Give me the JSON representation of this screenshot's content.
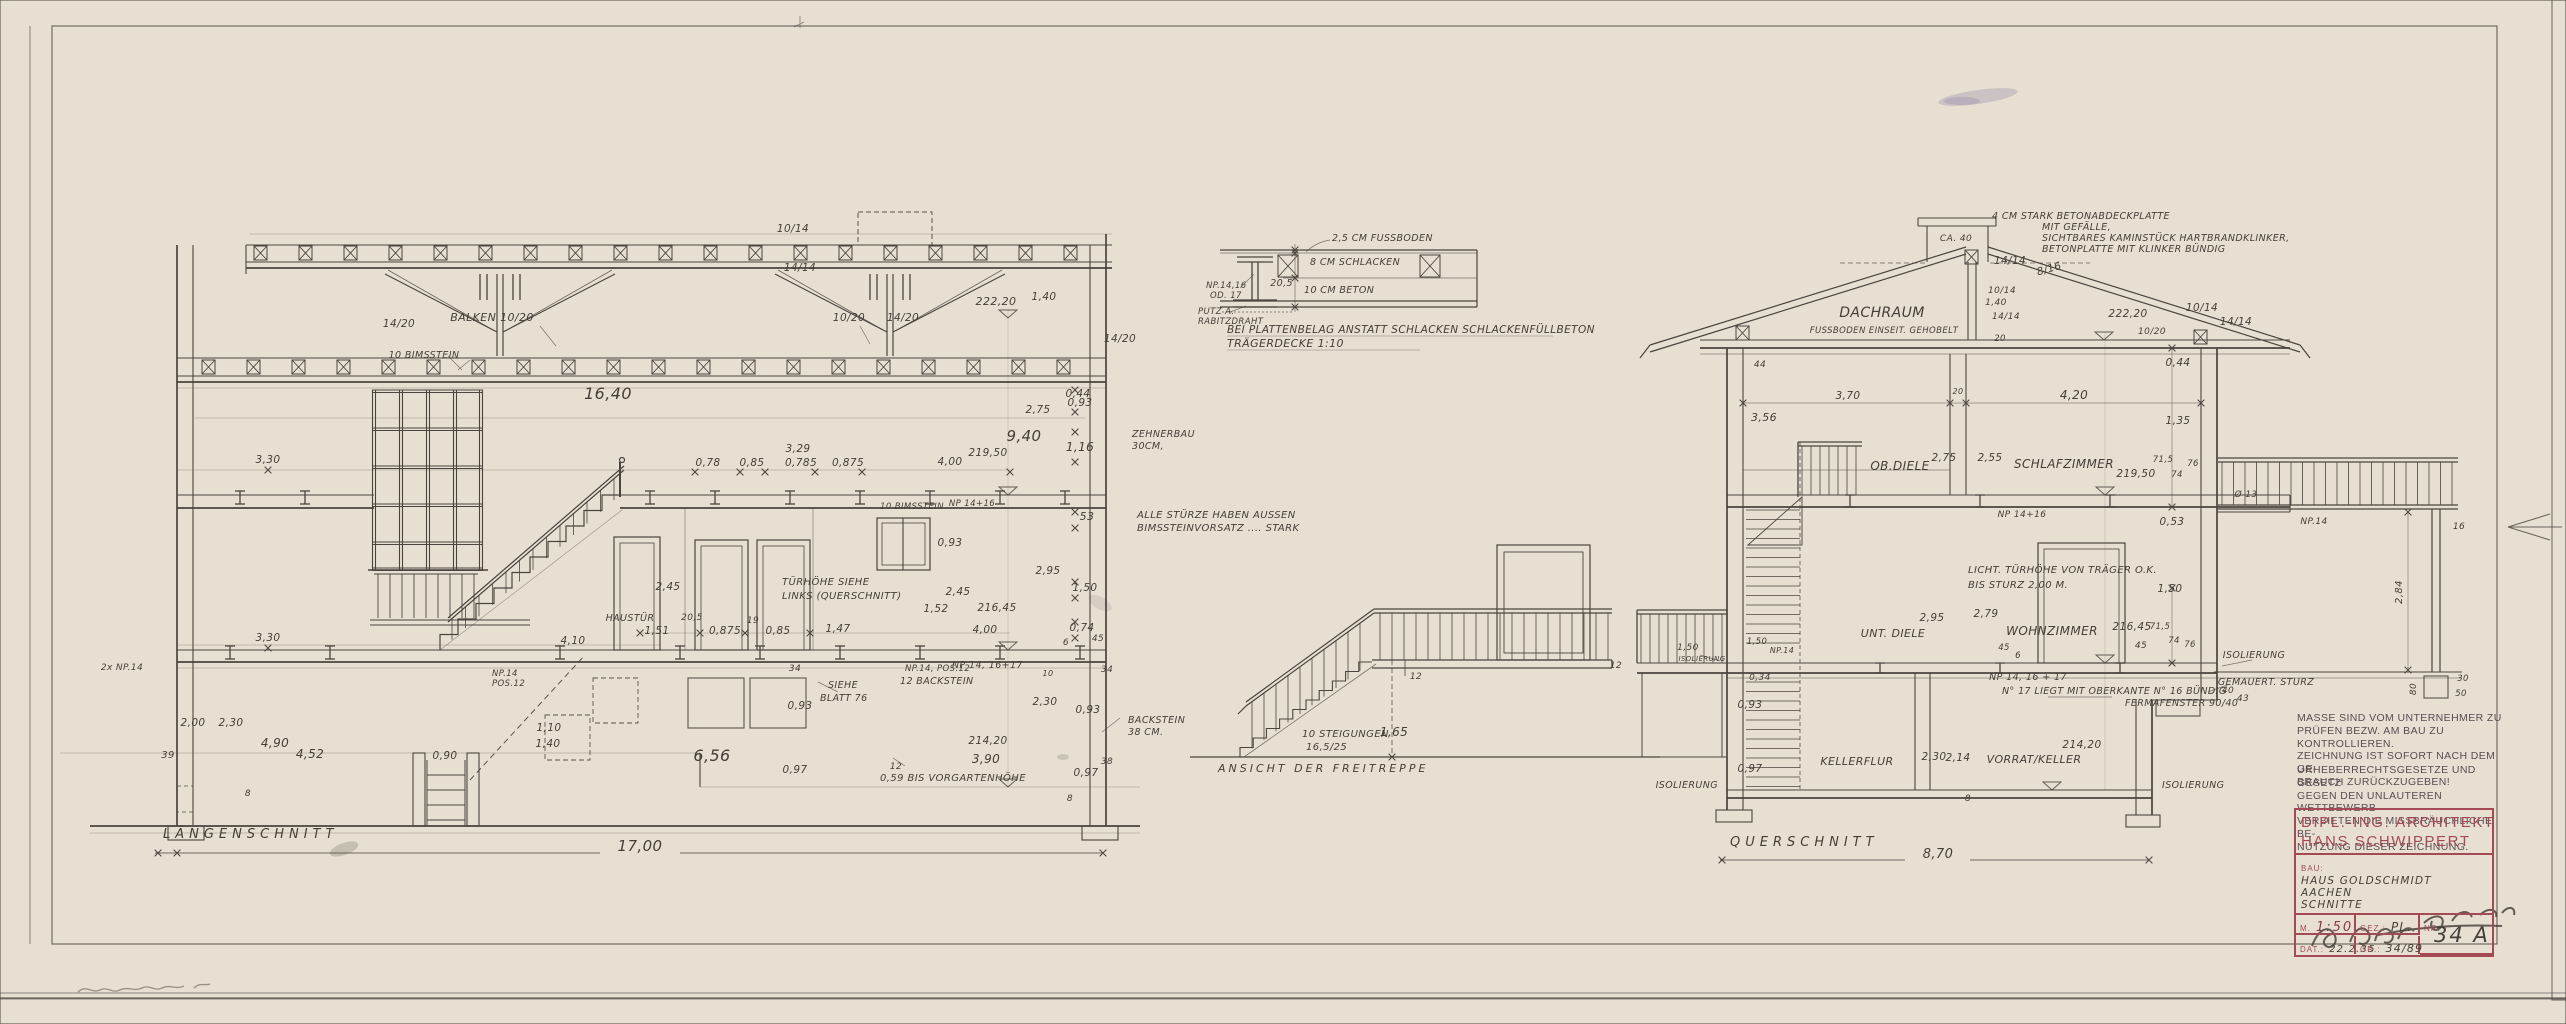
{
  "sheet": {
    "paper_color": "#e7dfd2",
    "ink_color": "#4a443e",
    "stamp_color": "#a34a56"
  },
  "drawings": {
    "laengsschnitt": {
      "title": "LÄNGENSCHNITT",
      "overall_dim": "17,00",
      "labels": [
        {
          "t": "10/14",
          "x": 793,
          "y": 232
        },
        {
          "t": "14/14",
          "x": 800,
          "y": 271
        },
        {
          "t": "14/20",
          "x": 399,
          "y": 327
        },
        {
          "t": "BALKEN 10/20",
          "x": 492,
          "y": 321,
          "s": 11
        },
        {
          "t": "10/20",
          "x": 849,
          "y": 321
        },
        {
          "t": "14/20",
          "x": 903,
          "y": 321
        },
        {
          "t": "14/20",
          "x": 1120,
          "y": 342
        },
        {
          "t": "10 BIMSSTEIN",
          "x": 424,
          "y": 358,
          "s": 9.5
        },
        {
          "t": "16,40",
          "x": 608,
          "y": 399,
          "s": 16
        },
        {
          "t": "222,20",
          "x": 996,
          "y": 305,
          "s": 11
        },
        {
          "t": "1,40",
          "x": 1044,
          "y": 300
        },
        {
          "t": "0,44",
          "x": 1078,
          "y": 397
        },
        {
          "t": "2,75",
          "x": 1038,
          "y": 413
        },
        {
          "t": "0,93",
          "x": 1080,
          "y": 406
        },
        {
          "t": "9,40",
          "x": 1024,
          "y": 441,
          "s": 15
        },
        {
          "t": "1,16",
          "x": 1080,
          "y": 451,
          "s": 12
        },
        {
          "t": "219,50",
          "x": 988,
          "y": 456
        },
        {
          "t": "4,00",
          "x": 950,
          "y": 465
        },
        {
          "t": "3,29",
          "x": 798,
          "y": 452
        },
        {
          "t": "0,78",
          "x": 708,
          "y": 466
        },
        {
          "t": "0,85",
          "x": 752,
          "y": 466
        },
        {
          "t": "0,785",
          "x": 801,
          "y": 466
        },
        {
          "t": "0,875",
          "x": 848,
          "y": 466
        },
        {
          "t": "ZEHNERBAU",
          "x": 1132,
          "y": 437,
          "a": "s",
          "s": 9.5
        },
        {
          "t": "30CM,",
          "x": 1132,
          "y": 449,
          "a": "s",
          "s": 9.5
        },
        {
          "t": "53",
          "x": 1087,
          "y": 520,
          "s": 11
        },
        {
          "t": "10 BIMSSTEIN",
          "x": 912,
          "y": 509,
          "s": 8.5
        },
        {
          "t": "NP 14+16",
          "x": 972,
          "y": 506,
          "s": 8.5
        },
        {
          "t": "ALLE STÜRZE HABEN AUSSEN",
          "x": 1137,
          "y": 518,
          "a": "s",
          "s": 10
        },
        {
          "t": "BIMSSTEINVORSATZ .... STARK",
          "x": 1137,
          "y": 531,
          "a": "s",
          "s": 10
        },
        {
          "t": "0,93",
          "x": 950,
          "y": 546
        },
        {
          "t": "2,95",
          "x": 1048,
          "y": 574
        },
        {
          "t": "1,50",
          "x": 1085,
          "y": 591
        },
        {
          "t": "2,45",
          "x": 668,
          "y": 590
        },
        {
          "t": "2,45",
          "x": 958,
          "y": 595
        },
        {
          "t": "1,52",
          "x": 936,
          "y": 612
        },
        {
          "t": "216,45",
          "x": 997,
          "y": 611
        },
        {
          "t": "TÜRHÖHE SIEHE",
          "x": 782,
          "y": 585,
          "a": "s",
          "s": 10
        },
        {
          "t": "LINKS (QUERSCHNITT)",
          "x": 782,
          "y": 599,
          "a": "s",
          "s": 10
        },
        {
          "t": "0,74",
          "x": 1082,
          "y": 631
        },
        {
          "t": "HAUSTÜR",
          "x": 630,
          "y": 621,
          "s": 9.5
        },
        {
          "t": "3,30",
          "x": 268,
          "y": 463
        },
        {
          "t": "3,30",
          "x": 268,
          "y": 641
        },
        {
          "t": "1,51",
          "x": 657,
          "y": 634
        },
        {
          "t": "4,10",
          "x": 573,
          "y": 644
        },
        {
          "t": "20,5",
          "x": 692,
          "y": 620,
          "s": 9
        },
        {
          "t": "19",
          "x": 753,
          "y": 623,
          "s": 9
        },
        {
          "t": "0,875",
          "x": 725,
          "y": 634
        },
        {
          "t": "0,85",
          "x": 778,
          "y": 634
        },
        {
          "t": "1,47",
          "x": 838,
          "y": 632
        },
        {
          "t": "4,00",
          "x": 985,
          "y": 633
        },
        {
          "t": "2x NP.14",
          "x": 122,
          "y": 670,
          "s": 9
        },
        {
          "t": "NP.14, POS.12",
          "x": 905,
          "y": 671,
          "a": "s",
          "s": 8.5
        },
        {
          "t": "12 BACKSTEIN",
          "x": 900,
          "y": 684,
          "a": "s",
          "s": 9.5
        },
        {
          "t": "NP 14, 16+17",
          "x": 952,
          "y": 668,
          "a": "s",
          "s": 9.5
        },
        {
          "t": "34",
          "x": 795,
          "y": 671,
          "s": 9
        },
        {
          "t": "SIEHE",
          "x": 828,
          "y": 688,
          "a": "s",
          "s": 9.5
        },
        {
          "t": "BLATT 76",
          "x": 820,
          "y": 701,
          "a": "s",
          "s": 9.5
        },
        {
          "t": "0,93",
          "x": 800,
          "y": 709
        },
        {
          "t": "2,30",
          "x": 1045,
          "y": 705
        },
        {
          "t": "0,93",
          "x": 1088,
          "y": 713
        },
        {
          "t": "2,00",
          "x": 193,
          "y": 726
        },
        {
          "t": "2,30",
          "x": 231,
          "y": 726
        },
        {
          "t": "4,90",
          "x": 275,
          "y": 747,
          "s": 12
        },
        {
          "t": "4,52",
          "x": 310,
          "y": 758,
          "s": 12
        },
        {
          "t": "39",
          "x": 168,
          "y": 758,
          "s": 10
        },
        {
          "t": "0,90",
          "x": 445,
          "y": 759
        },
        {
          "t": "1,40",
          "x": 548,
          "y": 747
        },
        {
          "t": "1,10",
          "x": 549,
          "y": 731
        },
        {
          "t": "NP.14",
          "x": 492,
          "y": 676,
          "a": "s",
          "s": 8.5
        },
        {
          "t": "POS.12",
          "x": 492,
          "y": 686,
          "a": "s",
          "s": 8.5
        },
        {
          "t": "6,56",
          "x": 712,
          "y": 761,
          "s": 16
        },
        {
          "t": "0,97",
          "x": 795,
          "y": 773
        },
        {
          "t": "0,59 BIS VORGARTENHÖHE",
          "x": 880,
          "y": 781,
          "a": "s",
          "s": 10
        },
        {
          "t": "12",
          "x": 896,
          "y": 769,
          "s": 9
        },
        {
          "t": "214,20",
          "x": 988,
          "y": 744
        },
        {
          "t": "3,90",
          "x": 986,
          "y": 763,
          "s": 12
        },
        {
          "t": "38",
          "x": 1107,
          "y": 764,
          "s": 9
        },
        {
          "t": "0,97",
          "x": 1086,
          "y": 776
        },
        {
          "t": "8",
          "x": 1070,
          "y": 801,
          "s": 9
        },
        {
          "t": "8",
          "x": 248,
          "y": 796,
          "s": 9
        },
        {
          "t": "6",
          "x": 1066,
          "y": 645,
          "s": 9
        },
        {
          "t": "45",
          "x": 1098,
          "y": 641,
          "s": 9
        },
        {
          "t": "34",
          "x": 1107,
          "y": 672,
          "s": 9
        },
        {
          "t": "10",
          "x": 1048,
          "y": 676,
          "s": 8
        },
        {
          "t": "BACKSTEIN",
          "x": 1128,
          "y": 723,
          "a": "s",
          "s": 9.5
        },
        {
          "t": "38 CM.",
          "x": 1128,
          "y": 735,
          "a": "s",
          "s": 9.5
        }
      ]
    },
    "querschnitt": {
      "title": "QUERSCHNITT",
      "overall_dim": "8,70",
      "labels": [
        {
          "t": "4 CM STARK BETONABDECKPLATTE",
          "x": 1992,
          "y": 219,
          "a": "s",
          "s": 9.5
        },
        {
          "t": "MIT GEFÄLLE,",
          "x": 2042,
          "y": 230,
          "a": "s",
          "s": 9.5
        },
        {
          "t": "SICHTBARES KAMINSTÜCK HARTBRANDKLINKER,",
          "x": 2042,
          "y": 241,
          "a": "s",
          "s": 9.5
        },
        {
          "t": "BETONPLATTE MIT KLINKER BÜNDIG",
          "x": 2042,
          "y": 252,
          "a": "s",
          "s": 9.5
        },
        {
          "t": "CA. 40",
          "x": 1956,
          "y": 241,
          "s": 9
        },
        {
          "t": "14/14",
          "x": 2010,
          "y": 264
        },
        {
          "t": "8/16",
          "x": 2050,
          "y": 272,
          "r": -16
        },
        {
          "t": "10/14",
          "x": 2002,
          "y": 293,
          "s": 9
        },
        {
          "t": "1,40",
          "x": 1996,
          "y": 305,
          "s": 9
        },
        {
          "t": "14/14",
          "x": 2006,
          "y": 319,
          "s": 9
        },
        {
          "t": "10/14",
          "x": 2202,
          "y": 311
        },
        {
          "t": "14/14",
          "x": 2236,
          "y": 325
        },
        {
          "t": "10/20",
          "x": 2152,
          "y": 334,
          "s": 9
        },
        {
          "t": "222,20",
          "x": 2128,
          "y": 317
        },
        {
          "t": "20",
          "x": 2000,
          "y": 341,
          "s": 8.5
        },
        {
          "t": "44",
          "x": 1760,
          "y": 367,
          "s": 9
        },
        {
          "t": "DACHRAUM",
          "x": 1882,
          "y": 317,
          "s": 14
        },
        {
          "t": "FUSSBODEN EINSEIT. GEHOBELT",
          "x": 1884,
          "y": 333,
          "s": 8.5
        },
        {
          "t": "3,70",
          "x": 1848,
          "y": 399
        },
        {
          "t": "20",
          "x": 1958,
          "y": 394,
          "s": 8
        },
        {
          "t": "4,20",
          "x": 2074,
          "y": 399,
          "s": 12
        },
        {
          "t": "3,56",
          "x": 1764,
          "y": 421,
          "s": 11
        },
        {
          "t": "0,44",
          "x": 2178,
          "y": 366
        },
        {
          "t": "1,35",
          "x": 2178,
          "y": 424
        },
        {
          "t": "OB.DIELE",
          "x": 1900,
          "y": 470,
          "s": 12
        },
        {
          "t": "2,75",
          "x": 1944,
          "y": 461
        },
        {
          "t": "2,55",
          "x": 1990,
          "y": 461
        },
        {
          "t": "SCHLAFZIMMER",
          "x": 2064,
          "y": 468,
          "s": 12
        },
        {
          "t": "219,50",
          "x": 2136,
          "y": 477
        },
        {
          "t": "71,5",
          "x": 2163,
          "y": 462,
          "s": 8.5
        },
        {
          "t": "76",
          "x": 2193,
          "y": 466,
          "s": 8.5
        },
        {
          "t": "74",
          "x": 2177,
          "y": 477,
          "s": 8.5
        },
        {
          "t": "0,53",
          "x": 2172,
          "y": 525
        },
        {
          "t": "NP 14+16",
          "x": 2022,
          "y": 517,
          "s": 9
        },
        {
          "t": "LICHT. TÜRHÖHE VON TRÄGER O.K.",
          "x": 1968,
          "y": 573,
          "a": "s",
          "s": 10
        },
        {
          "t": "BIS STURZ 2,00 M.",
          "x": 1968,
          "y": 588,
          "a": "s",
          "s": 10
        },
        {
          "t": "1,50",
          "x": 2170,
          "y": 592
        },
        {
          "t": "2,79",
          "x": 1986,
          "y": 617
        },
        {
          "t": "WOHNZIMMER",
          "x": 2052,
          "y": 635,
          "s": 12
        },
        {
          "t": "2,95",
          "x": 1932,
          "y": 621
        },
        {
          "t": "UNT. DIELE",
          "x": 1893,
          "y": 637,
          "s": 11
        },
        {
          "t": "216,45",
          "x": 2132,
          "y": 630
        },
        {
          "t": "45",
          "x": 2141,
          "y": 648,
          "s": 9
        },
        {
          "t": "71,5",
          "x": 2160,
          "y": 629,
          "s": 8.5
        },
        {
          "t": "74",
          "x": 2174,
          "y": 643,
          "s": 8.5
        },
        {
          "t": "76",
          "x": 2190,
          "y": 647,
          "s": 8.5
        },
        {
          "t": "45",
          "x": 2004,
          "y": 650,
          "s": 8.5
        },
        {
          "t": "6",
          "x": 2018,
          "y": 658,
          "s": 8.5
        },
        {
          "t": "1,50",
          "x": 1688,
          "y": 650,
          "s": 9
        },
        {
          "t": "ISOLIERUNG",
          "x": 1702,
          "y": 661,
          "s": 7
        },
        {
          "t": "12",
          "x": 1616,
          "y": 668,
          "s": 9
        },
        {
          "t": "0,34",
          "x": 1760,
          "y": 680,
          "s": 9
        },
        {
          "t": "NP.14",
          "x": 1782,
          "y": 653,
          "s": 8
        },
        {
          "t": "1,50",
          "x": 1757,
          "y": 644,
          "s": 8.5
        },
        {
          "t": "ISOLIERUNG",
          "x": 2254,
          "y": 658,
          "s": 9.5
        },
        {
          "t": "GEMAUERT. STURZ",
          "x": 2266,
          "y": 685,
          "s": 9.5
        },
        {
          "t": "40",
          "x": 2228,
          "y": 693,
          "s": 9
        },
        {
          "t": "43",
          "x": 2243,
          "y": 701,
          "s": 9
        },
        {
          "t": "NP 14, 16 + 17",
          "x": 2028,
          "y": 680,
          "s": 9.5
        },
        {
          "t": "N° 17 LIEGT MIT OBERKANTE N° 16 BÜNDIG",
          "x": 2002,
          "y": 694,
          "a": "s",
          "s": 9.5
        },
        {
          "t": "FERMAFENSTER 90/40",
          "x": 2125,
          "y": 706,
          "a": "s",
          "s": 9.5
        },
        {
          "t": "KELLERFLUR",
          "x": 1857,
          "y": 765,
          "s": 11
        },
        {
          "t": "2,30",
          "x": 1934,
          "y": 760
        },
        {
          "t": "2,14",
          "x": 1958,
          "y": 761
        },
        {
          "t": "VORRAT/KELLER",
          "x": 2034,
          "y": 763,
          "s": 11
        },
        {
          "t": "214,20",
          "x": 2082,
          "y": 748
        },
        {
          "t": "0,93",
          "x": 1750,
          "y": 708
        },
        {
          "t": "0,97",
          "x": 1750,
          "y": 772
        },
        {
          "t": "ISOLIERUNG",
          "x": 1718,
          "y": 788,
          "a": "e",
          "s": 9.5
        },
        {
          "t": "ISOLIERUNG",
          "x": 2162,
          "y": 788,
          "a": "s",
          "s": 9.5
        },
        {
          "t": "8",
          "x": 1968,
          "y": 801,
          "s": 9
        },
        {
          "t": "Ø 13",
          "x": 2246,
          "y": 497,
          "s": 9
        },
        {
          "t": "NP.14",
          "x": 2314,
          "y": 524,
          "s": 9
        },
        {
          "t": "16",
          "x": 2459,
          "y": 529,
          "s": 9
        },
        {
          "t": "2,84",
          "x": 2402,
          "y": 592,
          "r": -90,
          "s": 10
        },
        {
          "t": "80",
          "x": 2416,
          "y": 689,
          "r": -90,
          "s": 9
        },
        {
          "t": "30",
          "x": 2463,
          "y": 681,
          "s": 8.5
        },
        {
          "t": "50",
          "x": 2461,
          "y": 696,
          "s": 8.5
        }
      ]
    },
    "freitreppe": {
      "caption": "ANSICHT DER FREITREPPE",
      "labels": [
        {
          "t": "10 STEIGUNGEN",
          "x": 1302,
          "y": 737,
          "a": "s",
          "s": 10
        },
        {
          "t": "16,5/25",
          "x": 1306,
          "y": 750,
          "a": "s",
          "s": 10
        },
        {
          "t": "1,65",
          "x": 1394,
          "y": 736,
          "s": 12
        },
        {
          "t": "12",
          "x": 1416,
          "y": 679,
          "s": 9
        }
      ]
    },
    "traegerdecke": {
      "caption_line1": "BEI PLATTENBELAG ANSTATT SCHLACKEN SCHLACKENFÜLLBETON",
      "caption_line2": "TRÄGERDECKE 1:10",
      "labels": [
        {
          "t": "2,5 CM FUSSBODEN",
          "x": 1332,
          "y": 241,
          "a": "s",
          "s": 9.5
        },
        {
          "t": "8 CM SCHLACKEN",
          "x": 1310,
          "y": 265,
          "a": "s",
          "s": 9.5
        },
        {
          "t": "20,5",
          "x": 1293,
          "y": 286,
          "a": "e",
          "s": 9.5
        },
        {
          "t": "10 CM BETON",
          "x": 1304,
          "y": 293,
          "a": "s",
          "s": 9.5
        },
        {
          "t": "NP.14,16",
          "x": 1206,
          "y": 288,
          "a": "s",
          "s": 8.5
        },
        {
          "t": "OD. 17",
          "x": 1210,
          "y": 298,
          "a": "s",
          "s": 8.5
        },
        {
          "t": "PUTZ A.",
          "x": 1198,
          "y": 314,
          "a": "s",
          "s": 8.5
        },
        {
          "t": "RABITZDRAHT",
          "x": 1198,
          "y": 324,
          "a": "s",
          "s": 8.5
        }
      ]
    }
  },
  "notes": {
    "note1_lines": [
      "MASSE SIND VOM UNTERNEHMER ZU",
      "PRÜFEN BEZW. AM BAU ZU KONTROLLIEREN.",
      "ZEICHNUNG IST SOFORT NACH DEM GE-",
      "BRAUCH ZURÜCKZUGEBEN!"
    ],
    "note2_lines": [
      "URHEBERRECHTSGESETZE UND GESETZ",
      "GEGEN DEN UNLAUTEREN WETTBEWERB",
      "VERBIETEN DIE MISSBRÄUCHLICHE BE-",
      "NUTZUNG DIESER ZEICHNUNG."
    ]
  },
  "title_block": {
    "architect_line1": "DIPL.-ING. ARCHITEKT",
    "architect_line2": "HANS SCHWIPPERT",
    "bau_label": "BAU:",
    "bau_value_line1": "HAUS GOLDSCHMIDT AACHEN",
    "bau_value_line2": "SCHNITTE",
    "scale_label": "M.",
    "scale_value": "1:50",
    "gez_label": "GEZ.:",
    "gez_value": "PL.",
    "nr_label": "NR.",
    "nr_value": "34 A",
    "dat_label": "DAT.:",
    "dat_value": "22.2.35",
    "gr_label": "GR.:",
    "gr_value": "34/89"
  }
}
